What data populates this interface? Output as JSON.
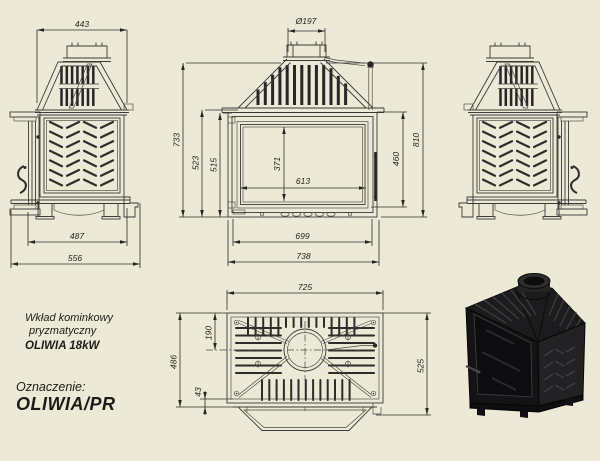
{
  "sheet": {
    "background": "#ece9d6",
    "line_color": "#3a3a38"
  },
  "product": {
    "line1": "Wkład kominkowy",
    "line2": "pryzmatyczny",
    "line3": "OLIWIA 18kW"
  },
  "designation": {
    "label": "Oznaczenie:",
    "value": "OLIWIA/PR"
  },
  "dims": {
    "d443": "443",
    "d487": "487",
    "d556": "556",
    "flue": "Ø197",
    "d733": "733",
    "d523": "523",
    "d515": "515",
    "d371": "371",
    "d613": "613",
    "d460": "460",
    "d810": "810",
    "d699": "699",
    "d738": "738",
    "d725": "725",
    "d486": "486",
    "d190": "190",
    "d43": "43",
    "d525": "525"
  }
}
